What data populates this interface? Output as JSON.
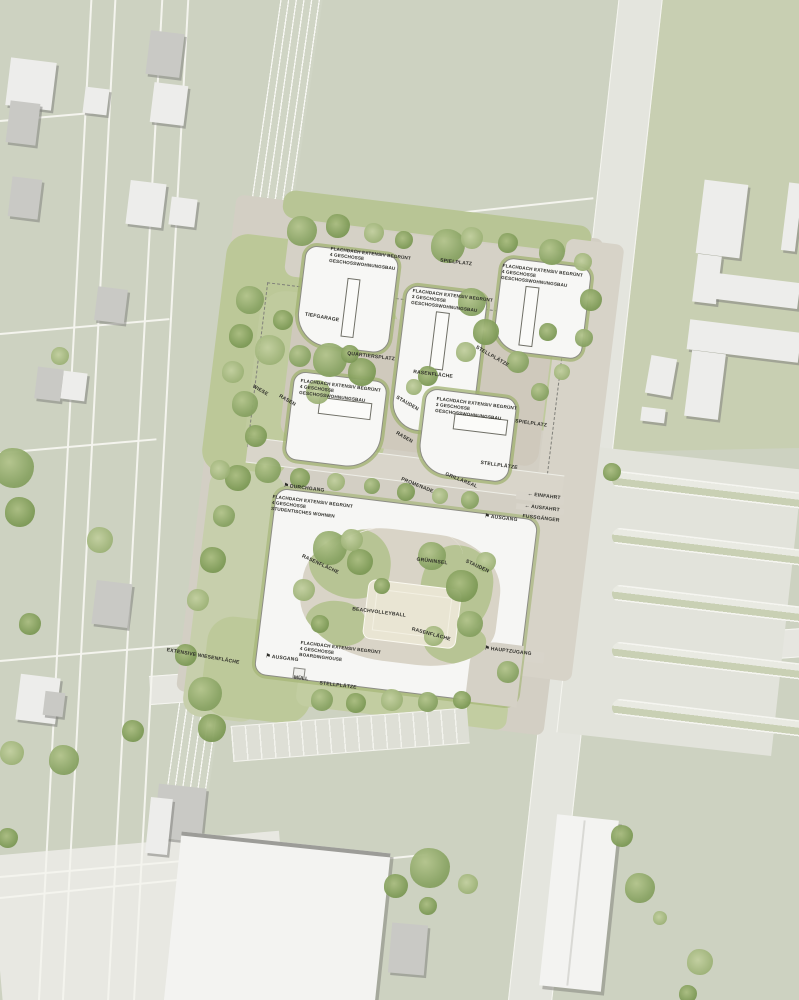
{
  "plan": {
    "colors": {
      "background_green": "#cdd2c1",
      "field_green": "#c8cfb2",
      "road_light": "#e4e5de",
      "road_line_white": "#f4f4ee",
      "site_paving": "#d3cfc4",
      "lawn_green": "#bdc998",
      "tree_green": "#8aa465",
      "hedge_green": "#a0b270",
      "building_white": "#f7f7f5",
      "existing_building_gray": "#c9c9c5",
      "sand_court": "#e9e5d3",
      "label_text": "#2e2e29"
    },
    "icons": {
      "flag": "⚑",
      "arrow": "←"
    },
    "building_labels": [
      {
        "id": "wohnbau-nw",
        "lines": [
          "FLACHDACH EXTENSIV BEGRÜNT",
          "4 GESCHOSSE",
          "GESCHOSSWOHNUNGSBAU"
        ],
        "x": 331,
        "y": 246,
        "rot": 7
      },
      {
        "id": "wohnbau-n-mitte",
        "lines": [
          "FLACHDACH EXTENSIV BEGRÜNT",
          "3 GESCHOSSE",
          "GESCHOSSWOHNUNGSBAU"
        ],
        "x": 413,
        "y": 288,
        "rot": 7
      },
      {
        "id": "wohnbau-ne",
        "lines": [
          "FLACHDACH EXTENSIV BEGRÜNT",
          "4 GESCHOSSE",
          "GESCHOSSWOHNUNGSBAU"
        ],
        "x": 503,
        "y": 263,
        "rot": 7
      },
      {
        "id": "wohnbau-w",
        "lines": [
          "FLACHDACH EXTENSIV BEGRÜNT",
          "4 GESCHOSSE",
          "GESCHOSSWOHNUNGSBAU"
        ],
        "x": 301,
        "y": 378,
        "rot": 7
      },
      {
        "id": "wohnbau-o",
        "lines": [
          "FLACHDACH EXTENSIV BEGRÜNT",
          "3 GESCHOSSE",
          "GESCHOSSWOHNUNGSBAU"
        ],
        "x": 437,
        "y": 396,
        "rot": 7
      },
      {
        "id": "studentisches-wohnen",
        "lines": [
          "FLACHDACH EXTENSIV BEGRÜNT",
          "4 GESCHOSSE",
          "STUDENTISCHES WOHNEN"
        ],
        "x": 273,
        "y": 494,
        "rot": 7
      },
      {
        "id": "boardinghouse",
        "lines": [
          "FLACHDACH EXTENSIV BEGRÜNT",
          "4 GESCHOSSE",
          "BOARDINGHOUSE"
        ],
        "x": 301,
        "y": 640,
        "rot": 7
      }
    ],
    "site_labels": [
      {
        "name": "spielplatz-nord",
        "text": "SPIELPLATZ",
        "x": 456,
        "y": 263,
        "rot": 7
      },
      {
        "name": "tiefgarage",
        "text": "TIEFGARAGE",
        "x": 322,
        "y": 318,
        "rot": 10
      },
      {
        "name": "quartiersplatz",
        "text": "QUARTIERSPLATZ",
        "x": 371,
        "y": 357,
        "rot": 7
      },
      {
        "name": "rasenflaeche-nord",
        "text": "RASENFLÄCHE",
        "x": 433,
        "y": 375,
        "rot": 7
      },
      {
        "name": "stellplaetze-nordost",
        "text": "STELLPLÄTZE",
        "x": 492,
        "y": 357,
        "rot": 30
      },
      {
        "name": "wiese",
        "text": "WIESE",
        "x": 260,
        "y": 391,
        "rot": 30
      },
      {
        "name": "rasen-west",
        "text": "RASEN",
        "x": 287,
        "y": 401,
        "rot": 30
      },
      {
        "name": "stauden-mitte",
        "text": "STAUDEN",
        "x": 407,
        "y": 404,
        "rot": 30
      },
      {
        "name": "rasen-mitte",
        "text": "RASEN",
        "x": 404,
        "y": 438,
        "rot": 30
      },
      {
        "name": "spielplatz-ost",
        "text": "SPIELPLATZ",
        "x": 531,
        "y": 424,
        "rot": 8
      },
      {
        "name": "stellplaetze-ost",
        "text": "STELLPLÄTZE",
        "x": 499,
        "y": 466,
        "rot": 8
      },
      {
        "name": "grillareal",
        "text": "GRILLAREAL",
        "x": 461,
        "y": 481,
        "rot": 22
      },
      {
        "name": "promenade",
        "text": "PROMENADE",
        "x": 417,
        "y": 486,
        "rot": 22
      },
      {
        "name": "durchgang",
        "text": "DURCHGANG",
        "x": 304,
        "y": 489,
        "rot": 7,
        "icon": "flag"
      },
      {
        "name": "ausgang-ost",
        "text": "AUSGANG",
        "x": 501,
        "y": 519,
        "rot": 7,
        "icon": "flag"
      },
      {
        "name": "einfahrt",
        "text": "EINFAHRT",
        "x": 544,
        "y": 497,
        "rot": 7,
        "icon": "arrow"
      },
      {
        "name": "ausfahrt",
        "text": "AUSFAHRT",
        "x": 542,
        "y": 509,
        "rot": 7,
        "icon": "arrow"
      },
      {
        "name": "fussgaenger",
        "text": "FUSSGÄNGER",
        "x": 541,
        "y": 519,
        "rot": 7
      },
      {
        "name": "rasenflaeche-hof-west",
        "text": "RASENFLÄCHE",
        "x": 320,
        "y": 565,
        "rot": 25
      },
      {
        "name": "gruensinsel",
        "text": "GRÜNINSEL",
        "x": 432,
        "y": 562,
        "rot": 7
      },
      {
        "name": "stauden-hof",
        "text": "STAUDEN",
        "x": 477,
        "y": 567,
        "rot": 25
      },
      {
        "name": "beachvolleyball",
        "text": "BEACHVOLLEYBALL",
        "x": 379,
        "y": 613,
        "rot": 7
      },
      {
        "name": "rasenflaeche-hof-sued",
        "text": "RASENFLÄCHE",
        "x": 431,
        "y": 635,
        "rot": 15
      },
      {
        "name": "hauptzugang",
        "text": "HAUPTZUGANG",
        "x": 508,
        "y": 652,
        "rot": 7,
        "icon": "flag"
      },
      {
        "name": "ausgang-sued",
        "text": "AUSGANG",
        "x": 282,
        "y": 659,
        "rot": 7,
        "icon": "flag"
      },
      {
        "name": "muell",
        "text": "MÜLL",
        "x": 301,
        "y": 679,
        "rot": 7
      },
      {
        "name": "stellplaetze-sued",
        "text": "STELLPLÄTZE",
        "x": 338,
        "y": 686,
        "rot": 7
      },
      {
        "name": "extensive-wiesenflaeche",
        "text": "EXTENSIVE WIESENFLÄCHE",
        "x": 203,
        "y": 657,
        "rot": 10
      }
    ]
  }
}
